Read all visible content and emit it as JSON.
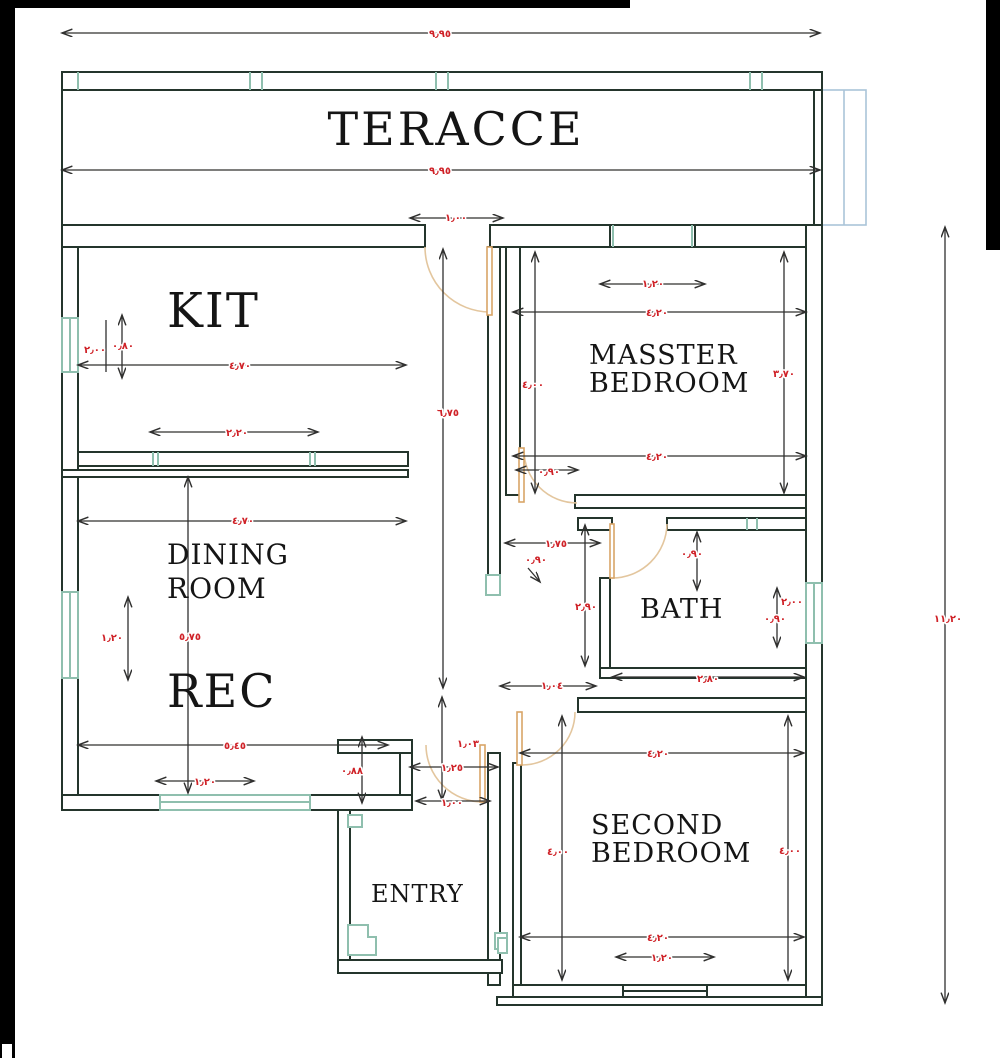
{
  "plan": {
    "rooms": {
      "terrace": "TERACCE",
      "kitchen": "KIT",
      "master_line1": "MASSTER",
      "master_line2": "BEDROOM",
      "dining_line1": "DINING",
      "dining_line2": "ROOM",
      "reception": "REC",
      "bath": "BATH",
      "second_line1": "SECOND",
      "second_line2": "BEDROOM",
      "entry": "ENTRY"
    },
    "dims": {
      "total_width_top": "٩٫٩٥",
      "terrace_width": "٩٫٩٥",
      "terrace_door_width": "١٫٠٠",
      "master_window_width": "١٫٢٠",
      "master_width_top": "٤٫٢٠",
      "master_height_left": "٤٫٠٠",
      "master_height_right": "٣٫٧٠",
      "master_width_bottom": "٤٫٢٠",
      "master_door_width": "٠٫٩٠",
      "kitchen_width": "٤٫٧٠",
      "kitchen_counter_width": "٢٫٢٠",
      "kitchen_window_height": "٢٫٠٠",
      "kitchen_side_height": "٠٫٨٠",
      "hall_height": "٦٫٧٥",
      "dining_width": "٤٫٧٠",
      "reception_height": "٥٫٧٥",
      "reception_window_height": "١٫٢٠",
      "reception_width_bottom": "٥٫٤٥",
      "reception_window_width": "١٫٢٠",
      "hall_width": "١٫٧٥",
      "hall_door_width": "٠٫٩٠",
      "bath_height_left": "٢٫٩٠",
      "bath_door_height": "٠٫٩٠",
      "bath_height_right": "٢٫٠٠",
      "bath_window_height": "٠٫٩٠",
      "bath_width_bottom": "٢٫٨٠",
      "second_door_width": "١٫٠٤",
      "second_width_top": "٤٫٢٠",
      "second_height_left": "٤٫٠٠",
      "second_height_right": "٤٫٠٠",
      "second_width_bottom": "٤٫٢٠",
      "second_window_width": "١٫٢٠",
      "entry_width_top": "١٫٢٥",
      "entry_door_height": "١٫٠٣",
      "entry_width_bottom": "١٫٠٠",
      "entry_side_height": "٠٫٨٨",
      "total_height_right": "١١٫٢٠"
    },
    "colors": {
      "wall": "#24352c",
      "dimension_text": "#cf2127",
      "window": "#8fbfae",
      "door": "#d9a567",
      "stairs": "#aac4d8"
    }
  }
}
